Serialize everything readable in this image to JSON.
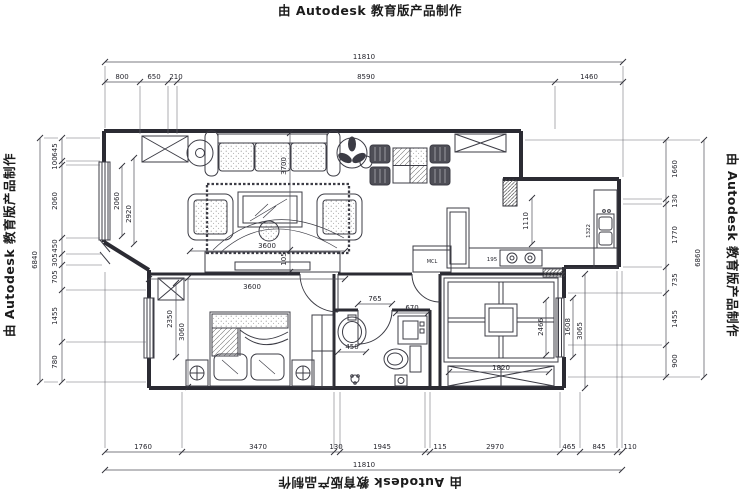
{
  "watermark": "由 Autodesk 教育版产品制作",
  "dims": {
    "top": {
      "total": "11810",
      "segments": [
        "800",
        "650",
        "210",
        "8590",
        "1460"
      ]
    },
    "bottom": {
      "total": "11810",
      "segments": [
        "1760",
        "3470",
        "130",
        "1945",
        "115",
        "2970",
        "465",
        "845",
        "110"
      ]
    },
    "left": {
      "total": "6840",
      "segments": [
        "645",
        "100",
        "2060",
        "450",
        "305",
        "705",
        "1455",
        "780"
      ]
    },
    "right": {
      "total": "6860",
      "segments": [
        "1660",
        "130",
        "1770",
        "735",
        "1455",
        "900"
      ]
    },
    "inner": {
      "living_bay_a": "2060",
      "living_bay_b": "2920",
      "sofa": "3700",
      "rug": "105",
      "tv_a": "3600",
      "tv_b": "3600",
      "bed_a": "2350",
      "bed_b": "3060",
      "kitchen": "1110",
      "sink": "1322",
      "stove": "195",
      "bath_door": "765",
      "bath_washer": "670",
      "bath_basin": "450",
      "tatami_a": "2466",
      "tatami_b": "1608",
      "tatami_c": "3065",
      "tatami_d": "1820"
    }
  },
  "labels": {
    "washer": "MCL"
  }
}
